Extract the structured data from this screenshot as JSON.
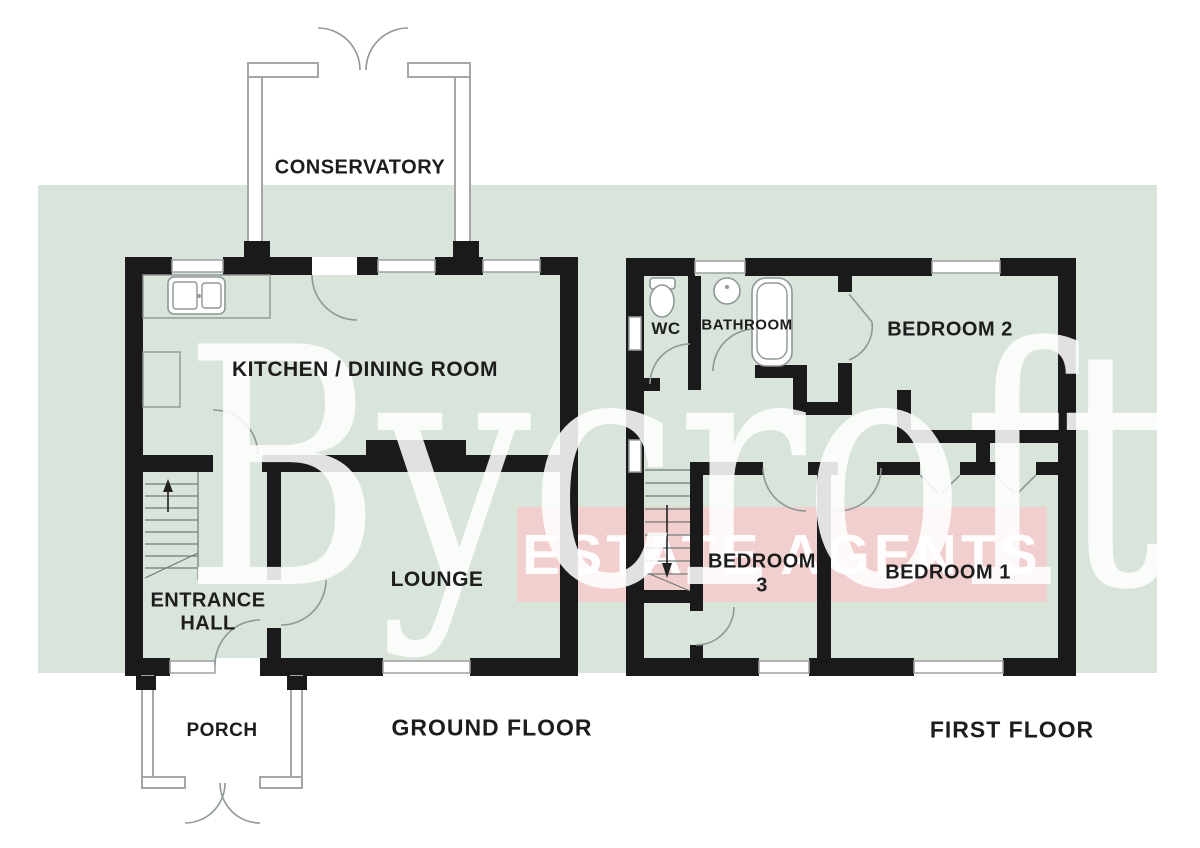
{
  "watermark": {
    "brand": "Bycroft",
    "banner": "ESTATE AGENTS"
  },
  "colors": {
    "band_green": "#d9e4da",
    "banner_pink": "#f4cbcb",
    "wall_black": "#1a1a1a",
    "label_text": "#1d1d1d",
    "fixture_gray": "#8e9896",
    "watermark_white": "#ffffff"
  },
  "ground_floor": {
    "title": "GROUND FLOOR",
    "rooms": {
      "conservatory": "CONSERVATORY",
      "kitchen_dining": "KITCHEN / DINING ROOM",
      "lounge": "LOUNGE",
      "entrance_hall_line1": "ENTRANCE",
      "entrance_hall_line2": "HALL",
      "porch": "PORCH"
    }
  },
  "first_floor": {
    "title": "FIRST FLOOR",
    "rooms": {
      "wc": "WC",
      "bathroom": "BATHROOM",
      "bedroom2": "BEDROOM 2",
      "bedroom3_line1": "BEDROOM",
      "bedroom3_line2": "3",
      "bedroom1": "BEDROOM 1"
    }
  }
}
